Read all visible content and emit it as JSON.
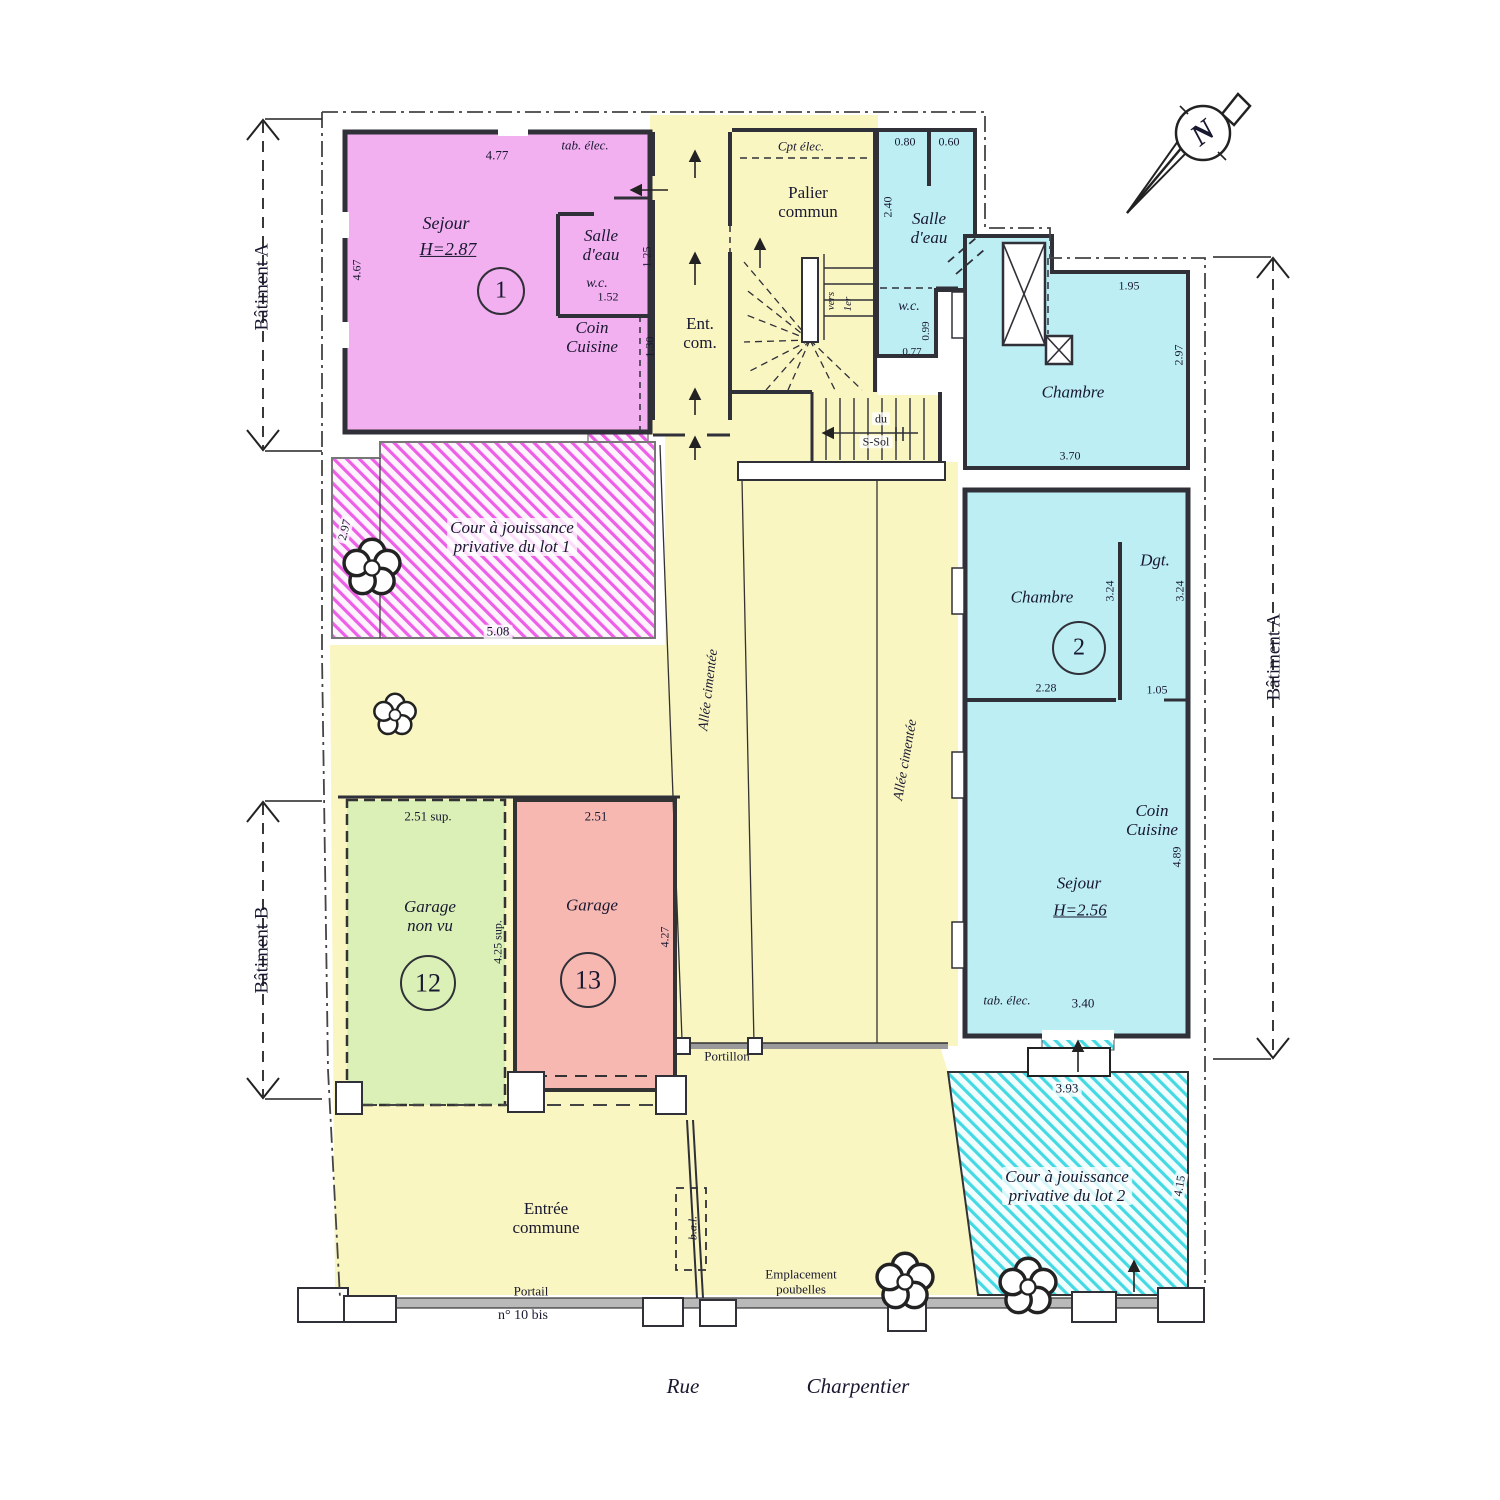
{
  "plan": {
    "street": {
      "word1": "Rue",
      "word2": "Charpentier"
    },
    "buildings": {
      "left_top": "Bâtiment A",
      "left_bottom": "Bâtiment B",
      "right_side": "Bâtiment A"
    },
    "compass": {
      "north": "N"
    },
    "colors": {
      "lot1": "#f3b0f0",
      "lot2": "#bceef4",
      "common": "#faf6c2",
      "garage12": "#daf0b6",
      "garage13": "#f7b8b2"
    },
    "lot1": {
      "room": "Sejour",
      "height": "H=2.87",
      "number": "1",
      "bath": "Salle\nd'eau",
      "wc": "w.c.",
      "kitchen": "Coin\nCuisine",
      "panel": "tab. élec.",
      "court": "Cour à jouissance\nprivative du lot 1",
      "dims": {
        "top": "4.77",
        "left": "4.67",
        "bath_w": "1.52",
        "bath_h": "1.25",
        "kitchen_h": "1.30",
        "court_w": "5.08",
        "court_h": "2.97"
      }
    },
    "common": {
      "hall": "Ent.\ncom.",
      "landing": "Palier\ncommun",
      "meter": "Cpt élec.",
      "stair_to": "vers",
      "stair_floor": "1er",
      "basement_1": "du",
      "basement_2": "S-Sol",
      "alley": "Allée cimentée",
      "entrance": "Entrée\ncommune",
      "gate_small": "Portillon",
      "gate_main": "Portail",
      "address": "n° 10 bis",
      "bins": "Emplacement\npoubelles",
      "mailbox": "b.a.l."
    },
    "lot2": {
      "bath": "Salle\nd'eau",
      "wc": "w.c.",
      "bedroom1": "Chambre",
      "bedroom2": "Chambre",
      "number": "2",
      "hallway": "Dgt.",
      "kitchen": "Coin\nCuisine",
      "room": "Sejour",
      "height": "H=2.56",
      "panel": "tab. élec.",
      "court": "Cour à jouissance\nprivative du lot 2",
      "dims": {
        "bath_a": "0.80",
        "bath_b": "0.60",
        "bath_h": "2.40",
        "wc_h": "0.99",
        "wc_w": "0.77",
        "bed1_top": "1.95",
        "bed1_right": "2.97",
        "bed1_bottom": "3.70",
        "bed2_h": "3.24",
        "hall_h": "3.24",
        "bed2_w": "2.28",
        "hall_w": "1.05",
        "kitchen_h": "4.89",
        "room_w": "3.40",
        "court_top": "3.93",
        "court_right": "4.15"
      }
    },
    "garage12": {
      "name": "Garage\nnon vu",
      "number": "12",
      "width": "2.51 sup.",
      "depth": "4.25 sup."
    },
    "garage13": {
      "name": "Garage",
      "number": "13",
      "width": "2.51",
      "depth": "4.27"
    }
  }
}
